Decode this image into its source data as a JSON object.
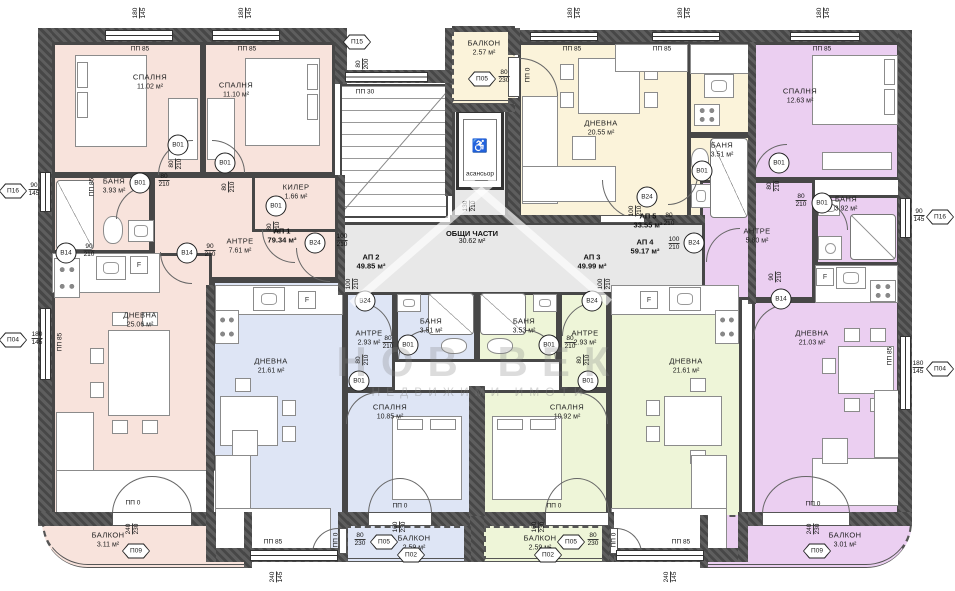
{
  "watermark": {
    "title": "НОВ ВЕК",
    "subtitle": "НЕДВИЖИМИ ИМОТИ"
  },
  "common": {
    "name": "ОБЩИ ЧАСТИ",
    "area": "30.62 м²",
    "elevator": "асансьор"
  },
  "apartments": [
    {
      "id": "АП 1",
      "area": "79.34 м²",
      "x": 282,
      "y": 236
    },
    {
      "id": "АП 2",
      "area": "49.85 м²",
      "x": 371,
      "y": 262
    },
    {
      "id": "АП 3",
      "area": "49.99 м²",
      "x": 592,
      "y": 262
    },
    {
      "id": "АП 4",
      "area": "59.17 м²",
      "x": 645,
      "y": 247
    },
    {
      "id": "АП 5",
      "area": "33.55 м²",
      "x": 648,
      "y": 221
    }
  ],
  "rooms": [
    {
      "apt": "АП 1",
      "name": "СПАЛНЯ",
      "area": "11.02 м²",
      "x": 52,
      "y": 42,
      "w": 151,
      "h": 133,
      "c": "#f8e3dc",
      "lx": 150,
      "ly": 82
    },
    {
      "apt": "АП 1",
      "name": "СПАЛНЯ",
      "area": "11.10 м²",
      "x": 203,
      "y": 42,
      "w": 132,
      "h": 133,
      "c": "#f8e3dc",
      "lx": 236,
      "ly": 90
    },
    {
      "apt": "АП 1",
      "name": "АНТРЕ",
      "area": "7.61 м²",
      "x": 152,
      "y": 175,
      "w": 186,
      "h": 105,
      "c": "#f8e3dc",
      "lx": 240,
      "ly": 246
    },
    {
      "apt": "АП 1",
      "name": "БАНЯ",
      "area": "3.93 м²",
      "x": 52,
      "y": 175,
      "w": 100,
      "h": 78,
      "c": "#f8e3dc",
      "lx": 114,
      "ly": 186
    },
    {
      "apt": "АП 1",
      "name": "КИЛЕР",
      "area": "1.66 м²",
      "x": 252,
      "y": 175,
      "w": 86,
      "h": 57,
      "c": "#f8e3dc",
      "lx": 296,
      "ly": 192
    },
    {
      "apt": "АП 1",
      "name": "ДНЕВНА",
      "area": "25.06 м²",
      "x": 52,
      "y": 253,
      "w": 160,
      "h": 262,
      "c": "#f8e3dc",
      "lx": 140,
      "ly": 320
    },
    {
      "apt": "АП 1",
      "name": "БАЛКОН",
      "area": "3.11 м²",
      "x": 42,
      "y": 515,
      "w": 208,
      "h": 53,
      "c": "#f8e3dc",
      "lx": 108,
      "ly": 540,
      "round": "bl"
    },
    {
      "apt": "АП 2",
      "name": "ДНЕВНА",
      "area": "21.61 м²",
      "x": 212,
      "y": 280,
      "w": 133,
      "h": 282,
      "c": "#dee5f5",
      "lx": 271,
      "ly": 366
    },
    {
      "apt": "АП 2",
      "name": "АНТРЕ",
      "area": "2.93 м²",
      "x": 345,
      "y": 292,
      "w": 50,
      "h": 98,
      "c": "#dee5f5",
      "lx": 369,
      "ly": 338
    },
    {
      "apt": "АП 2",
      "name": "БАНЯ",
      "area": "3.51 м²",
      "x": 395,
      "y": 290,
      "w": 82,
      "h": 72,
      "c": "#dee5f5",
      "lx": 431,
      "ly": 326
    },
    {
      "apt": "АП 2",
      "name": "СПАЛНЯ",
      "area": "10.85 м²",
      "x": 345,
      "y": 390,
      "w": 127,
      "h": 125,
      "c": "#dee5f5",
      "lx": 390,
      "ly": 412
    },
    {
      "apt": "АП 2",
      "name": "БАЛКОН",
      "area": "2.59 м²",
      "x": 345,
      "y": 526,
      "w": 125,
      "h": 36,
      "c": "#dee5f5",
      "lx": 414,
      "ly": 543
    },
    {
      "apt": "АП 3",
      "name": "ДНЕВНА",
      "area": "21.61 м²",
      "x": 609,
      "y": 280,
      "w": 133,
      "h": 282,
      "c": "#eef5d8",
      "lx": 686,
      "ly": 366
    },
    {
      "apt": "АП 3",
      "name": "АНТРЕ",
      "area": "2.93 м²",
      "x": 559,
      "y": 292,
      "w": 50,
      "h": 98,
      "c": "#eef5d8",
      "lx": 585,
      "ly": 338
    },
    {
      "apt": "АП 3",
      "name": "БАНЯ",
      "area": "3.53 м²",
      "x": 477,
      "y": 290,
      "w": 82,
      "h": 72,
      "c": "#eef5d8",
      "lx": 524,
      "ly": 326
    },
    {
      "apt": "АП 3",
      "name": "СПАЛНЯ",
      "area": "10.92 м²",
      "x": 482,
      "y": 390,
      "w": 127,
      "h": 125,
      "c": "#eef5d8",
      "lx": 567,
      "ly": 412
    },
    {
      "apt": "АП 3",
      "name": "БАЛКОН",
      "area": "2.59 м²",
      "x": 484,
      "y": 526,
      "w": 124,
      "h": 36,
      "c": "#eef5d8",
      "lx": 540,
      "ly": 543
    },
    {
      "apt": "АП 5",
      "name": "ДНЕВНА",
      "area": "20.55 м²",
      "x": 518,
      "y": 42,
      "w": 172,
      "h": 180,
      "c": "#fbf3da",
      "lx": 601,
      "ly": 128
    },
    {
      "apt": "АП 5",
      "name": "",
      "area": "",
      "x": 688,
      "y": 42,
      "w": 64,
      "h": 93,
      "c": "#fbf3da"
    },
    {
      "apt": "АП 5",
      "name": "БАНЯ",
      "area": "3.51 м²",
      "x": 688,
      "y": 135,
      "w": 64,
      "h": 87,
      "c": "#fbf3da",
      "lx": 722,
      "ly": 150
    },
    {
      "apt": "АП 5",
      "name": "БАЛКОН",
      "area": "2.57 м²",
      "x": 452,
      "y": 30,
      "w": 63,
      "h": 74,
      "c": "#fbf3da",
      "lx": 484,
      "ly": 48
    },
    {
      "apt": "АП 4",
      "name": "СПАЛНЯ",
      "area": "12.63 м²",
      "x": 752,
      "y": 42,
      "w": 148,
      "h": 138,
      "c": "#ebcff1",
      "lx": 800,
      "ly": 96
    },
    {
      "apt": "АП 4",
      "name": "АНТРЕ",
      "area": "5.80 м²",
      "x": 700,
      "y": 180,
      "w": 115,
      "h": 120,
      "c": "#ebcff1",
      "lx": 757,
      "ly": 236
    },
    {
      "apt": "АП 4",
      "name": "БАНЯ",
      "area": "3.92 м²",
      "x": 815,
      "y": 195,
      "w": 85,
      "h": 70,
      "c": "#ebcff1",
      "lx": 846,
      "ly": 204
    },
    {
      "apt": "АП 4",
      "name": "",
      "area": "",
      "x": 815,
      "y": 265,
      "w": 85,
      "h": 40,
      "c": "#ebcff1"
    },
    {
      "apt": "АП 4",
      "name": "ДНЕВНА",
      "area": "21.03 м²",
      "x": 752,
      "y": 300,
      "w": 148,
      "h": 215,
      "c": "#ebcff1",
      "lx": 812,
      "ly": 338
    },
    {
      "apt": "АП 4",
      "name": "БАЛКОН",
      "area": "3.01 м²",
      "x": 700,
      "y": 515,
      "w": 212,
      "h": 53,
      "c": "#ebcff1",
      "lx": 845,
      "ly": 540,
      "round": "br"
    },
    {
      "apt": "",
      "name": "",
      "area": "",
      "x": 338,
      "y": 222,
      "w": 367,
      "h": 73,
      "c": "#e8e8e8"
    },
    {
      "apt": "",
      "name": "",
      "area": "",
      "x": 452,
      "y": 104,
      "w": 56,
      "h": 118,
      "c": "#e8e8e8"
    }
  ],
  "door_tags": [
    {
      "label": "B01",
      "a": "80",
      "b": "210",
      "x": 178,
      "y": 145,
      "dx": 176,
      "dy": 164,
      "dv": true
    },
    {
      "label": "B01",
      "a": "80",
      "b": "210",
      "x": 225,
      "y": 163,
      "dx": 229,
      "dy": 187,
      "dv": true
    },
    {
      "label": "B01",
      "a": "80",
      "b": "210",
      "x": 140,
      "y": 183,
      "dx": 164,
      "dy": 181,
      "dv": false
    },
    {
      "label": "B01",
      "a": "80",
      "b": "210",
      "x": 276,
      "y": 206,
      "dx": 274,
      "dy": 227,
      "dv": true
    },
    {
      "label": "B14",
      "a": "90",
      "b": "210",
      "x": 187,
      "y": 253,
      "dx": 210,
      "dy": 251,
      "dv": false
    },
    {
      "label": "B14",
      "a": "90",
      "b": "210",
      "x": 66,
      "y": 253,
      "dx": 89,
      "dy": 251,
      "dv": false
    },
    {
      "label": "B24",
      "a": "100",
      "b": "210",
      "x": 315,
      "y": 243,
      "dx": 342,
      "dy": 241,
      "dv": false
    },
    {
      "label": "B24",
      "a": "100",
      "b": "210",
      "x": 365,
      "y": 301,
      "dx": 353,
      "dy": 284,
      "dv": true
    },
    {
      "label": "B01",
      "a": "80",
      "b": "210",
      "x": 408,
      "y": 345,
      "dx": 388,
      "dy": 343,
      "dv": false
    },
    {
      "label": "B01",
      "a": "80",
      "b": "210",
      "x": 359,
      "y": 381,
      "dx": 363,
      "dy": 360,
      "dv": true
    },
    {
      "label": "B24",
      "a": "100",
      "b": "210",
      "x": 592,
      "y": 301,
      "dx": 605,
      "dy": 284,
      "dv": true
    },
    {
      "label": "B01",
      "a": "80",
      "b": "210",
      "x": 549,
      "y": 345,
      "dx": 570,
      "dy": 343,
      "dv": false
    },
    {
      "label": "B01",
      "a": "80",
      "b": "210",
      "x": 588,
      "y": 381,
      "dx": 584,
      "dy": 360,
      "dv": true
    },
    {
      "label": "B24",
      "a": "100",
      "b": "210",
      "x": 647,
      "y": 197,
      "dx": 636,
      "dy": 211,
      "dv": true
    },
    {
      "label": "B01",
      "a": "80",
      "b": "210",
      "x": 702,
      "y": 171,
      "dx": 669,
      "dy": 220,
      "dv": false
    },
    {
      "label": "B24",
      "a": "100",
      "b": "210",
      "x": 694,
      "y": 243,
      "dx": 674,
      "dy": 244,
      "dv": false
    },
    {
      "label": "B01",
      "a": "80",
      "b": "210",
      "x": 779,
      "y": 163,
      "dx": 774,
      "dy": 186,
      "dv": true
    },
    {
      "label": "B01",
      "a": "80",
      "b": "210",
      "x": 822,
      "y": 203,
      "dx": 801,
      "dy": 201,
      "dv": false
    },
    {
      "label": "B14",
      "a": "90",
      "b": "210",
      "x": 781,
      "y": 299,
      "dx": 776,
      "dy": 277,
      "dv": true
    }
  ],
  "window_tags": [
    {
      "label": "П15",
      "a": "80",
      "b": "200",
      "x": 357,
      "y": 42,
      "dx": 363,
      "dy": 64,
      "dv": true
    },
    {
      "label": "П05",
      "a": "80",
      "b": "230",
      "x": 482,
      "y": 79,
      "dx": 504,
      "dy": 77,
      "dv": false
    },
    {
      "label": "П16",
      "a": "90",
      "b": "145",
      "x": 13,
      "y": 191,
      "dx": 34,
      "dy": 190,
      "dv": false
    },
    {
      "label": "П04",
      "a": "180",
      "b": "145",
      "x": 13,
      "y": 340,
      "dx": 37,
      "dy": 339,
      "dv": false
    },
    {
      "label": "П16",
      "a": "90",
      "b": "145",
      "x": 940,
      "y": 217,
      "dx": 919,
      "dy": 216,
      "dv": false
    },
    {
      "label": "П04",
      "a": "180",
      "b": "145",
      "x": 940,
      "y": 369,
      "dx": 918,
      "dy": 368,
      "dv": false
    },
    {
      "label": "П09",
      "a": "240",
      "b": "230",
      "x": 136,
      "y": 551,
      "dx": 133,
      "dy": 529,
      "dv": true
    },
    {
      "label": "П05",
      "a": "80",
      "b": "230",
      "x": 384,
      "y": 542,
      "dx": 360,
      "dy": 540,
      "dv": false
    },
    {
      "label": "П02",
      "a": "160",
      "b": "230",
      "x": 411,
      "y": 555,
      "dx": 400,
      "dy": 527,
      "dv": true
    },
    {
      "label": "П02",
      "a": "160",
      "b": "230",
      "x": 548,
      "y": 555,
      "dx": 539,
      "dy": 527,
      "dv": true
    },
    {
      "label": "П05",
      "a": "80",
      "b": "230",
      "x": 571,
      "y": 542,
      "dx": 593,
      "dy": 540,
      "dv": false
    },
    {
      "label": "П09",
      "a": "240",
      "b": "230",
      "x": 817,
      "y": 551,
      "dx": 814,
      "dy": 529,
      "dv": true
    }
  ],
  "sill_labels": [
    {
      "t": "ПП 85",
      "x": 140,
      "y": 49
    },
    {
      "t": "ПП 85",
      "x": 247,
      "y": 49
    },
    {
      "t": "ПП 85",
      "x": 572,
      "y": 49
    },
    {
      "t": "ПП 85",
      "x": 662,
      "y": 49
    },
    {
      "t": "ПП 85",
      "x": 822,
      "y": 49
    },
    {
      "t": "ПП 30",
      "x": 365,
      "y": 92
    },
    {
      "t": "ПП 85",
      "x": 273,
      "y": 542
    },
    {
      "t": "ПП 85",
      "x": 681,
      "y": 542
    },
    {
      "t": "ПП 0",
      "x": 133,
      "y": 503
    },
    {
      "t": "ПП 0",
      "x": 400,
      "y": 506
    },
    {
      "t": "ПП 0",
      "x": 554,
      "y": 506
    },
    {
      "t": "ПП 0",
      "x": 813,
      "y": 504
    },
    {
      "t": "ПП 85",
      "x": 92,
      "y": 187,
      "v": true
    },
    {
      "t": "ПП 85",
      "x": 60,
      "y": 342,
      "v": true
    },
    {
      "t": "ПП 85",
      "x": 890,
      "y": 356,
      "v": true
    },
    {
      "t": "ПП 0",
      "x": 528,
      "y": 75,
      "v": true
    },
    {
      "t": "ПП 0",
      "x": 336,
      "y": 540,
      "v": true
    },
    {
      "t": "ПП 0",
      "x": 614,
      "y": 540,
      "v": true
    }
  ],
  "dim_pairs": [
    {
      "a": "180",
      "b": "145",
      "x": 140,
      "y": 13
    },
    {
      "a": "180",
      "b": "145",
      "x": 246,
      "y": 13
    },
    {
      "a": "180",
      "b": "145",
      "x": 575,
      "y": 13
    },
    {
      "a": "180",
      "b": "145",
      "x": 685,
      "y": 13
    },
    {
      "a": "180",
      "b": "145",
      "x": 824,
      "y": 13
    },
    {
      "a": "240",
      "b": "145",
      "x": 277,
      "y": 577
    },
    {
      "a": "240",
      "b": "145",
      "x": 671,
      "y": 577
    },
    {
      "a": "130",
      "b": "210",
      "x": 470,
      "y": 206
    }
  ],
  "fridge_label": "F",
  "fridges": [
    {
      "x": 130,
      "y": 256
    },
    {
      "x": 298,
      "y": 291
    },
    {
      "x": 640,
      "y": 291
    },
    {
      "x": 816,
      "y": 268
    }
  ]
}
